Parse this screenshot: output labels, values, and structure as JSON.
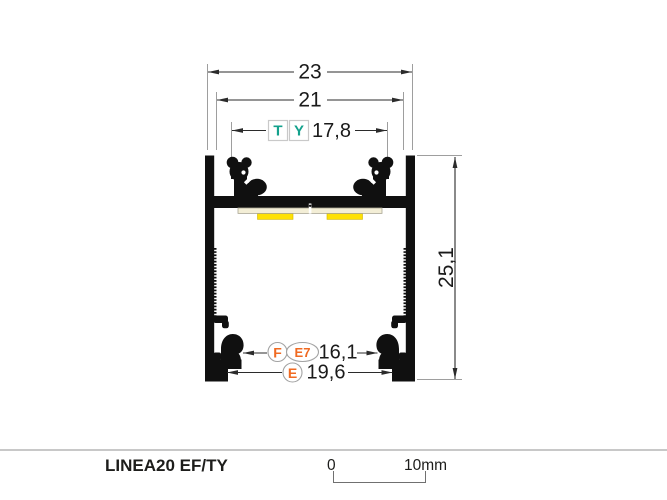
{
  "drawing": {
    "dims": {
      "outer_width": {
        "value": "23"
      },
      "top_width": {
        "value": "21"
      },
      "cover_groove_width": {
        "value": "17,8",
        "tag_t": "T",
        "tag_y": "Y"
      },
      "height": {
        "value": "25,1"
      },
      "hook_inner_width": {
        "value": "16,1",
        "tag_f": "F",
        "tag_e7": "E7"
      },
      "base_inner_width": {
        "value": "19,6",
        "tag_e": "E"
      }
    },
    "colors": {
      "profile_black": "#101010",
      "tag_teal": "#13a18c",
      "tag_orange": "#f06a22",
      "led_yellow": "#fee104",
      "pcb_cream": "#f3eed6",
      "dimension_line": "#2b2b2b",
      "extension_line": "#9e9e9e"
    }
  },
  "footer": {
    "title": "LINEA20 EF/TY",
    "scale_bar": {
      "start_label": "0",
      "end_label": "10mm"
    }
  }
}
